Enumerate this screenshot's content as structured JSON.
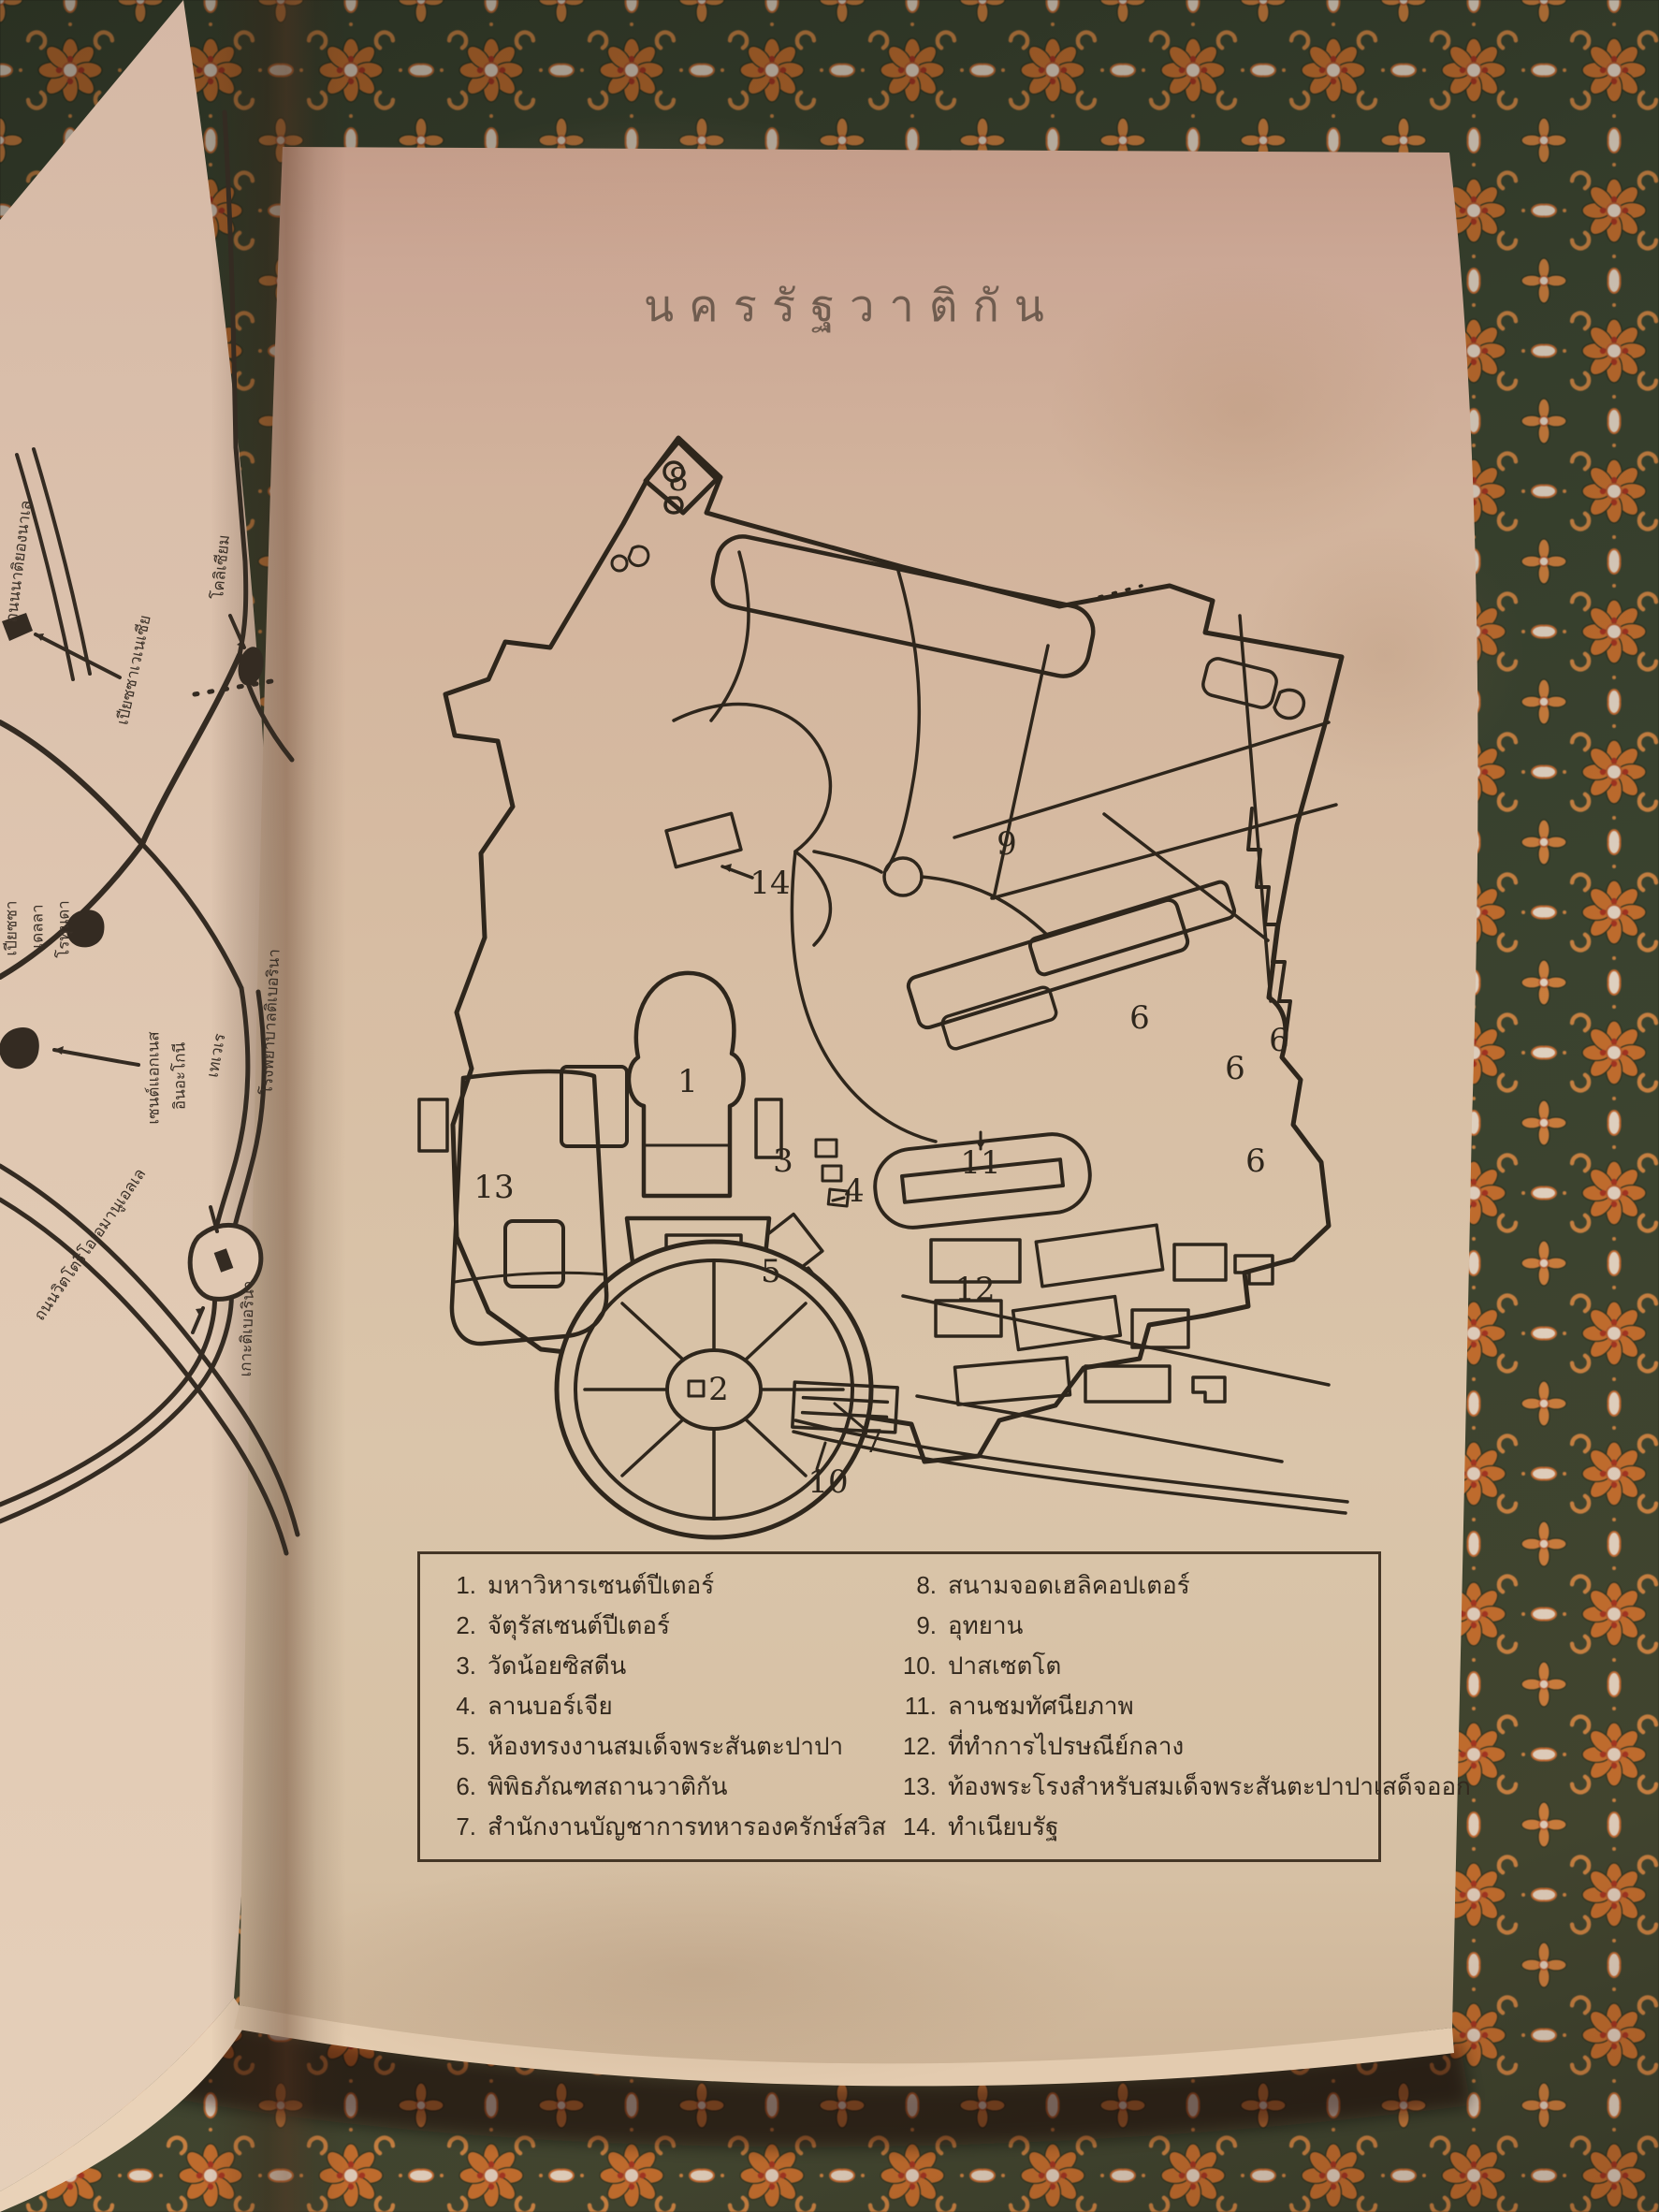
{
  "title": "นครรัฐวาติกัน",
  "legend": {
    "items": [
      {
        "num": "1.",
        "label": "มหาวิหารเซนต์ปีเตอร์"
      },
      {
        "num": "2.",
        "label": "จัตุรัสเซนต์ปีเตอร์"
      },
      {
        "num": "3.",
        "label": "วัดน้อยซิสตีน"
      },
      {
        "num": "4.",
        "label": "ลานบอร์เจีย"
      },
      {
        "num": "5.",
        "label": "ห้องทรงงานสมเด็จพระสันตะปาปา"
      },
      {
        "num": "6.",
        "label": "พิพิธภัณฑสถานวาติกัน"
      },
      {
        "num": "7.",
        "label": "สำนักงานบัญชาการทหารองครักษ์สวิส"
      },
      {
        "num": "8.",
        "label": "สนามจอดเฮลิคอปเตอร์"
      },
      {
        "num": "9.",
        "label": "อุทยาน"
      },
      {
        "num": "10.",
        "label": "ปาสเซตโต"
      },
      {
        "num": "11.",
        "label": "ลานชมทัศนียภาพ"
      },
      {
        "num": "12.",
        "label": "ที่ทำการไปรษณีย์กลาง"
      },
      {
        "num": "13.",
        "label": "ท้องพระโรงสำหรับสมเด็จพระสันตะปาปาเสด็จออก"
      },
      {
        "num": "14.",
        "label": "ทำเนียบรัฐ"
      }
    ]
  },
  "map": {
    "numbers": [
      {
        "t": "8"
      },
      {
        "t": "14"
      },
      {
        "t": "9"
      },
      {
        "t": "6"
      },
      {
        "t": "6"
      },
      {
        "t": "6"
      },
      {
        "t": "6"
      },
      {
        "t": "1"
      },
      {
        "t": "11"
      },
      {
        "t": "13"
      },
      {
        "t": "3"
      },
      {
        "t": "4"
      },
      {
        "t": "5"
      },
      {
        "t": "12"
      },
      {
        "t": "2"
      },
      {
        "t": "7"
      },
      {
        "t": "10"
      }
    ]
  },
  "left_page_labels": [
    {
      "text": "ถนนนาติยองนาเล"
    },
    {
      "text": "เปียซซาเวเนเซีย"
    },
    {
      "text": "โคลิเซียม"
    },
    {
      "text": "เปียซซา"
    },
    {
      "text": "เดลลา"
    },
    {
      "text": "โรทุนดา"
    },
    {
      "text": "เซนต์แอกเนส"
    },
    {
      "text": "อินอะโกนี"
    },
    {
      "text": "เทเวเร"
    },
    {
      "text": "โรงพยาบาลติเบอรินา"
    },
    {
      "text": "เกาะติเบอรินา"
    },
    {
      "text": "ถนนวิตโตริโอเอมานูเอลเล"
    }
  ],
  "colors": {
    "fabric_base": "#3b4531",
    "fabric_orange": "#c6702f",
    "fabric_cream": "#e6d6c5",
    "fabric_red": "#a63422",
    "page": "#d8c2a7",
    "ink": "#2e261c"
  }
}
